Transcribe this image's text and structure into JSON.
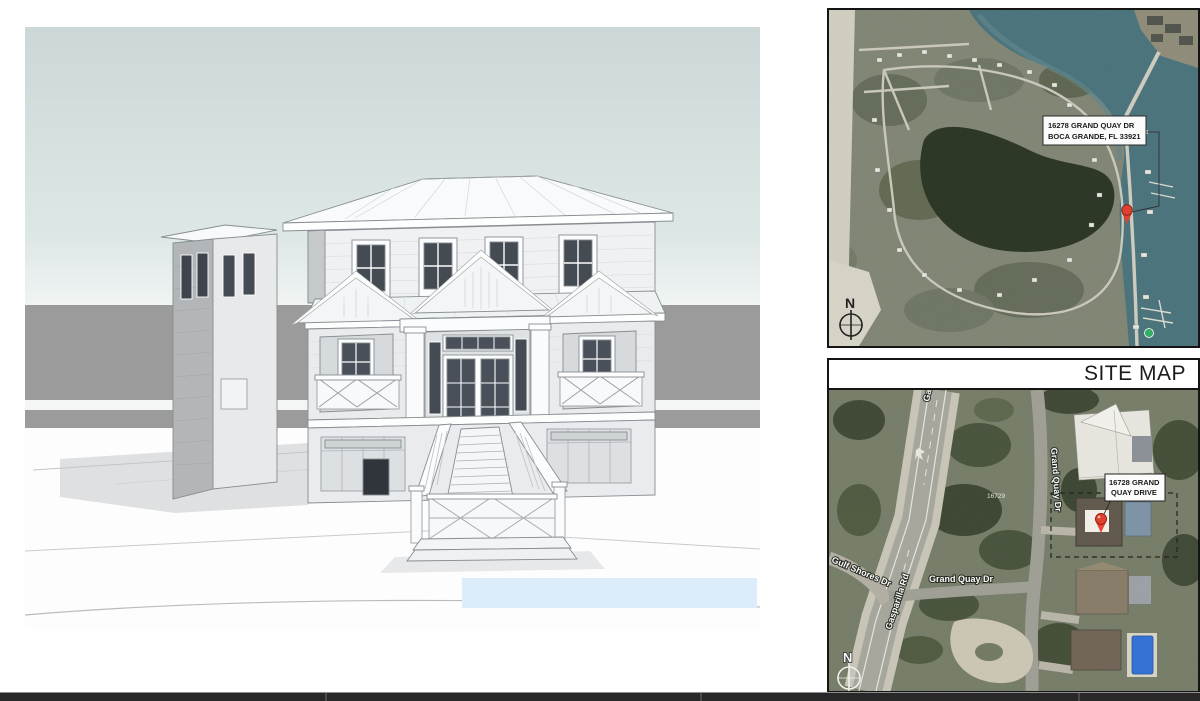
{
  "colors": {
    "page_bg": "#ffffff",
    "bottom_bar": "#282828",
    "sky_top": "#cbd8d7",
    "sky_bottom": "#f0f4f3",
    "backdrop_band": "#9b9b9b",
    "render_pool": "#dcecfa",
    "house_front": "#eff1f3",
    "house_side": "#b3b6b9",
    "house_roof": "#f8fafb",
    "house_outline": "#878d91",
    "window_glass": "#454b52",
    "map_border": "#141414",
    "water": "#46707a",
    "land": "#7e8372",
    "lake": "#26301f",
    "beach": "#d2cfc2",
    "road": "#c9c6b8",
    "asphalt": "#a6a69c",
    "marker_red": "#e23b28",
    "swimming_pool_blue": "#2f6fd6",
    "site_title_color": "#1b1b1b"
  },
  "site_map": {
    "title": "SITE MAP",
    "top_map": {
      "address_label": {
        "line1": "16278 GRAND QUAY DR",
        "line2": "BOCA GRANDE, FL 33921"
      },
      "compass": "N"
    },
    "bottom_map": {
      "property_label": {
        "line1": "16728 GRAND",
        "line2": "QUAY DRIVE"
      },
      "compass": "N",
      "labels": {
        "gasparilla_top": "Gaspar",
        "gasparilla_road": "Gasparilla Rd",
        "gulf_shores": "Gulf Shores Dr",
        "grand_quay": "Grand Quay Dr",
        "grand_quay_vertical": "Grand Quay Dr",
        "parcel": "16729"
      }
    }
  }
}
